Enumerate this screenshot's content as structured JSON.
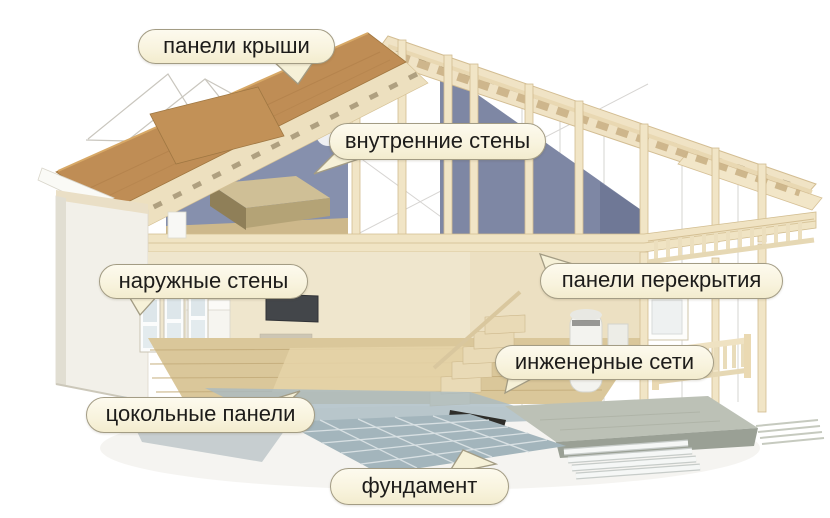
{
  "diagram": {
    "title_hidden": "",
    "callouts": [
      {
        "id": "roof-panels",
        "label": "панели крыши",
        "target": "roof"
      },
      {
        "id": "inner-walls",
        "label": "внутренние стены",
        "target": "interior-walls"
      },
      {
        "id": "outer-walls",
        "label": "наружные стены",
        "target": "exterior-walls"
      },
      {
        "id": "floor-panels",
        "label": "панели перекрытия",
        "target": "floor-slabs"
      },
      {
        "id": "utilities",
        "label": "инженерные сети",
        "target": "engineering-systems"
      },
      {
        "id": "plinth-panels",
        "label": "цокольные панели",
        "target": "basement-panels"
      },
      {
        "id": "foundation",
        "label": "фундамент",
        "target": "foundation"
      }
    ],
    "colors": {
      "bubble_fill": "#f8f3dd",
      "bubble_border": "#a39c84",
      "bubble_text": "#1d1c1a",
      "roof_panel_tan": "#bf8d55",
      "wood_light": "#efe2c3",
      "interior_wall_blue": "#7e87a4",
      "concrete_gray": "#bcc1b6",
      "rebar_slab_blue": "#a3b5bc",
      "background": "#ffffff"
    }
  }
}
